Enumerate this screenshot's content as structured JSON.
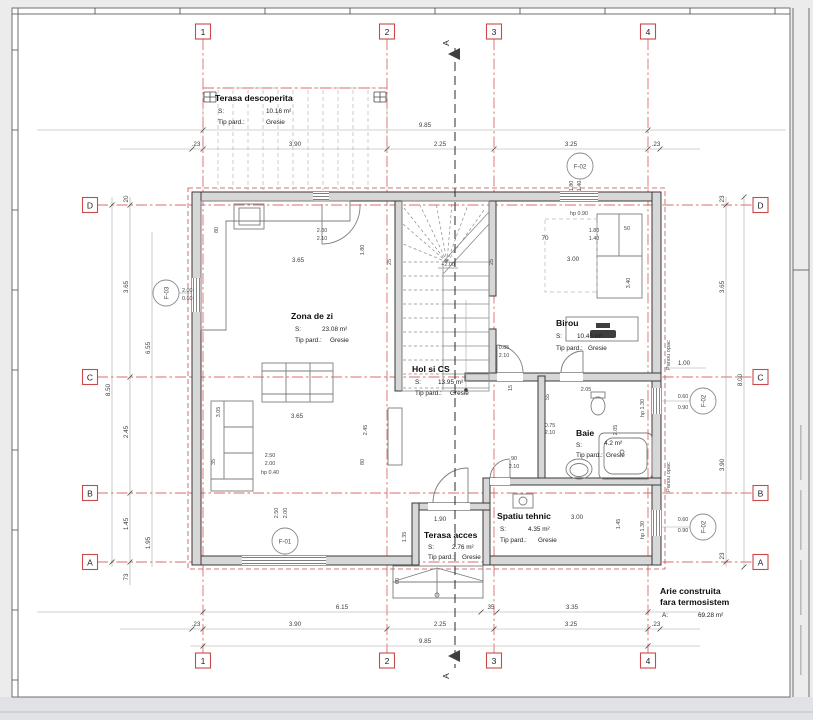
{
  "grid": {
    "cols": [
      "1",
      "2",
      "3",
      "4"
    ],
    "rows": [
      "D",
      "C",
      "B",
      "A"
    ]
  },
  "section_label": "A",
  "rooms": {
    "terasa_descoperita": {
      "name": "Terasa descoperita",
      "s": "S:",
      "area": "10.16 m²",
      "tip": "Tip pard.:",
      "floor": "Gresie"
    },
    "zona_de_zi": {
      "name": "Zona de zi",
      "s": "S:",
      "area": "23.08 m²",
      "tip": "Tip pard.:",
      "floor": "Gresie"
    },
    "hol": {
      "name": "Hol si CS",
      "s": "S:",
      "area": "13.95 m²",
      "tip": "Tip pard.:",
      "floor": "Gresie"
    },
    "birou": {
      "name": "Birou",
      "s": "S:",
      "area": "10.45 m²",
      "tip": "Tip pard.:",
      "floor": "Gresie"
    },
    "baie": {
      "name": "Baie",
      "s": "S:",
      "area": "4.2 m²",
      "tip": "Tip pard.:",
      "floor": "Gresie"
    },
    "spatiu_tehnic": {
      "name": "Spatiu tehnic",
      "s": "S:",
      "area": "4.35 m²",
      "tip": "Tip pard.:",
      "floor": "Gresie"
    },
    "terasa_acces": {
      "name": "Terasa acces",
      "s": "S:",
      "area": "2.76 m²",
      "tip": "Tip pard.:",
      "floor": "Gresie"
    }
  },
  "summary": {
    "line1": "Arie construita",
    "line2": "fara termosistem",
    "a": "A:",
    "value": "69.28 m²"
  },
  "markers": {
    "f01": "F-01",
    "f02": "F-02",
    "f03": "F-03",
    "f02r": "F-02",
    "f02b": "F-02"
  },
  "notes": {
    "panou_opac": "Panou opac",
    "panou_opac2": "Panou opac",
    "level": "+2.00",
    "hp040": "hp 0.40",
    "hp090": "hp 0.90",
    "hp130a": "hp 1.30",
    "hp130b": "hp 1.30"
  },
  "dims": {
    "top_total": "9.85",
    "top_23l": ".23",
    "top_390": "3.90",
    "top_225": "2.25",
    "top_325": "3.25",
    "top_23r": ".23",
    "bot_615": "6.15",
    "bot_35": "35",
    "bot_335": "3.35",
    "bot_23l": ".23",
    "bot_390": "3.90",
    "bot_225": "2.25",
    "bot_325": "3.25",
    "bot_23r": ".23",
    "bot_total": "9.85",
    "l_20": "20",
    "l_365": "3.65",
    "l_655": "6.55",
    "l_850": "8.50",
    "l_245": "2.45",
    "l_145": "1.45",
    "l_195": "1.95",
    "l_73": "73",
    "r_23t": "23",
    "r_365": "3.65",
    "r_800": "8.00",
    "r_390": "3.90",
    "r_23b": "23",
    "r_100": "1.00",
    "w_060a": "0.60",
    "w_090a": "0.90",
    "w_060b": "0.60",
    "w_090b": "0.90",
    "k_80": "80",
    "k_365": "3.65",
    "k_200": "2.00",
    "k_210": "2.10",
    "k_180": "1.80",
    "s_25l": "25",
    "s_25r": "25",
    "s_70": "70",
    "z_365": "3.65",
    "z_305": "3.05",
    "z_245": "2.45",
    "z_250": "2.50",
    "z_200": "2.00",
    "z_35": "35",
    "z_80": "80",
    "f03_200": "2.00",
    "f03_060": "0.60",
    "f01_250": "2.50",
    "f01_200": "2.00",
    "h_085": "0.85",
    "h_210": "2.10",
    "h_15": "15",
    "h_55": "55",
    "h_205": "2.05",
    "h_90": "90",
    "h_210b": "2.10",
    "ba_075": "0.75",
    "ba_210": "2.10",
    "ba_205": "2.05",
    "bi_180": "1.80",
    "bi_140": "1.40",
    "bi_300": "3.00",
    "bi_50": "50",
    "bi_340": "3.40",
    "st_300": "3.00",
    "st_145": "1.45",
    "ta_190": "1.90",
    "ta_135": "1.35",
    "ta_60": "60"
  }
}
